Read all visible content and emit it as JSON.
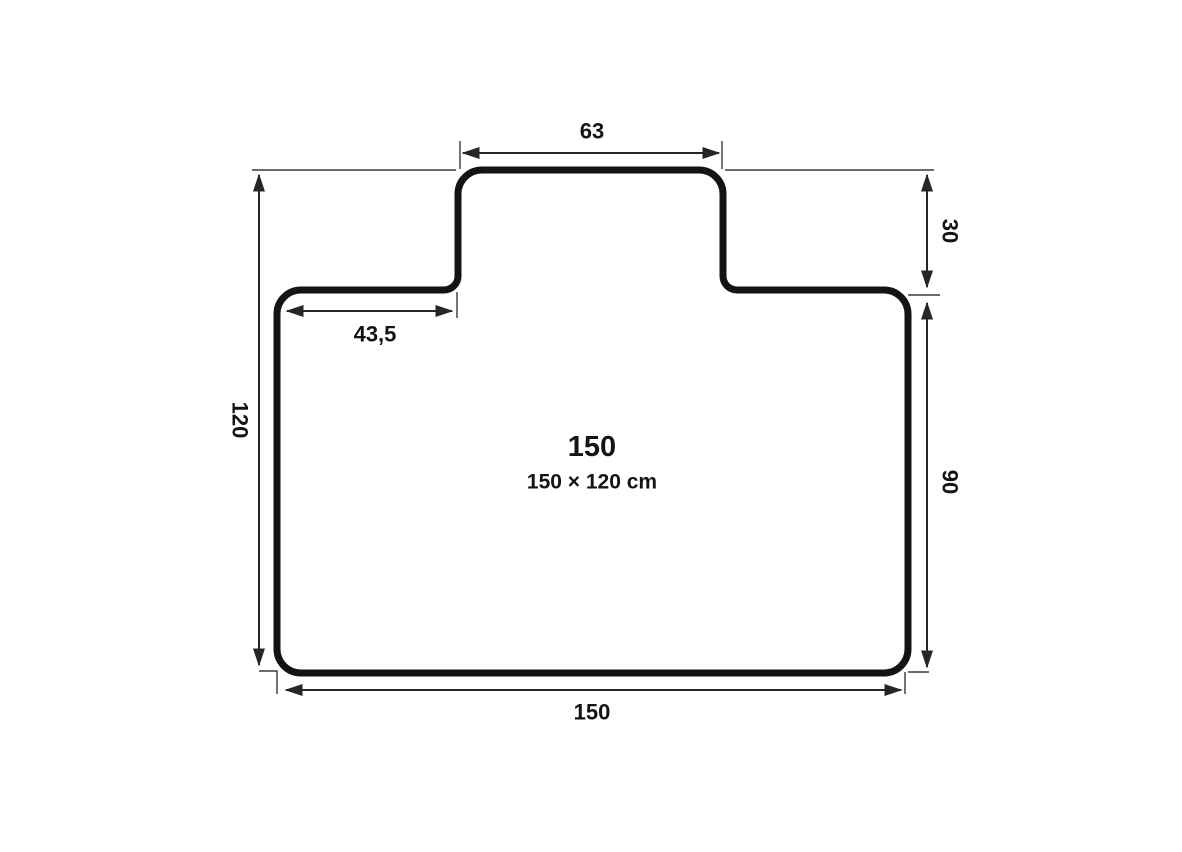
{
  "diagram": {
    "type": "chair-mat-dimension-drawing",
    "center_label": {
      "primary": "150",
      "secondary": "150 × 120 cm"
    },
    "dims": {
      "tab_width": "63",
      "tab_height": "30",
      "shoulder_width": "43,5",
      "total_height": "120",
      "body_height": "90",
      "total_width": "150"
    },
    "colors": {
      "outline": "#141414",
      "dimension_lines": "#262626",
      "text": "#141414",
      "background": "#ffffff"
    }
  }
}
